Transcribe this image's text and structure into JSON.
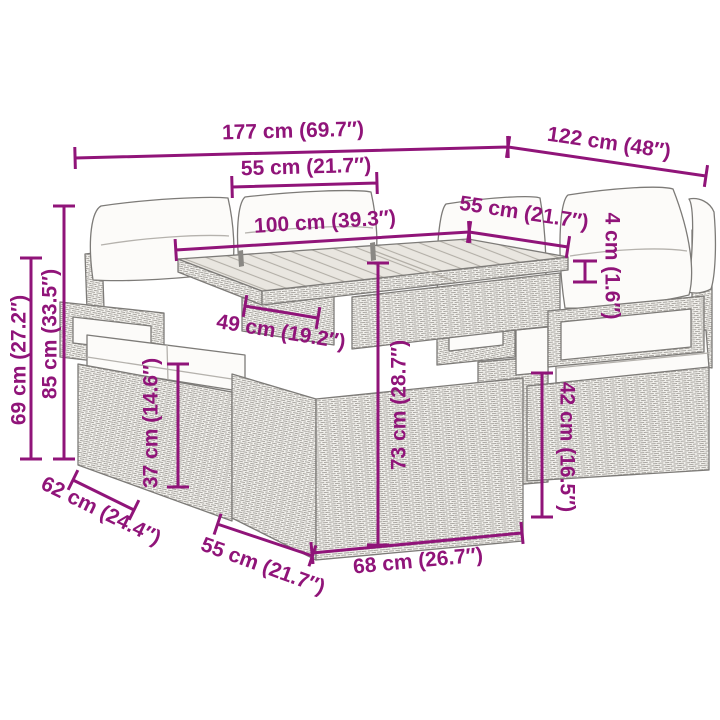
{
  "figure": {
    "type": "product-dimension-diagram",
    "subject": "rattan garden furniture set (sofa, dining table, chairs) line drawing",
    "background_color": "#ffffff",
    "accent_color": "#901479",
    "drawing_color": "#7d7b78",
    "dims": {
      "total_width": "177 cm (69.7″)",
      "total_depth": "122 cm (48″)",
      "sofa_seat_width": "55 cm (21.7″)",
      "table_top_length": "100 cm (39.3″)",
      "chair_width": "55 cm (21.7″)",
      "table_top_thickness": "4 cm (1.6″)",
      "back_height": "85 cm (33.5″)",
      "armrest_height": "69 cm (27.2″)",
      "table_front_panel_width": "49 cm (19.2″)",
      "sofa_seat_height": "37 cm (14.6″)",
      "table_height": "73 cm (28.7″)",
      "chair_seat_height": "42 cm (16.5″)",
      "sofa_depth": "62 cm (24.4″)",
      "table_base_depth": "55 cm (21.7″)",
      "table_base_width": "68 cm (26.7″)"
    }
  }
}
